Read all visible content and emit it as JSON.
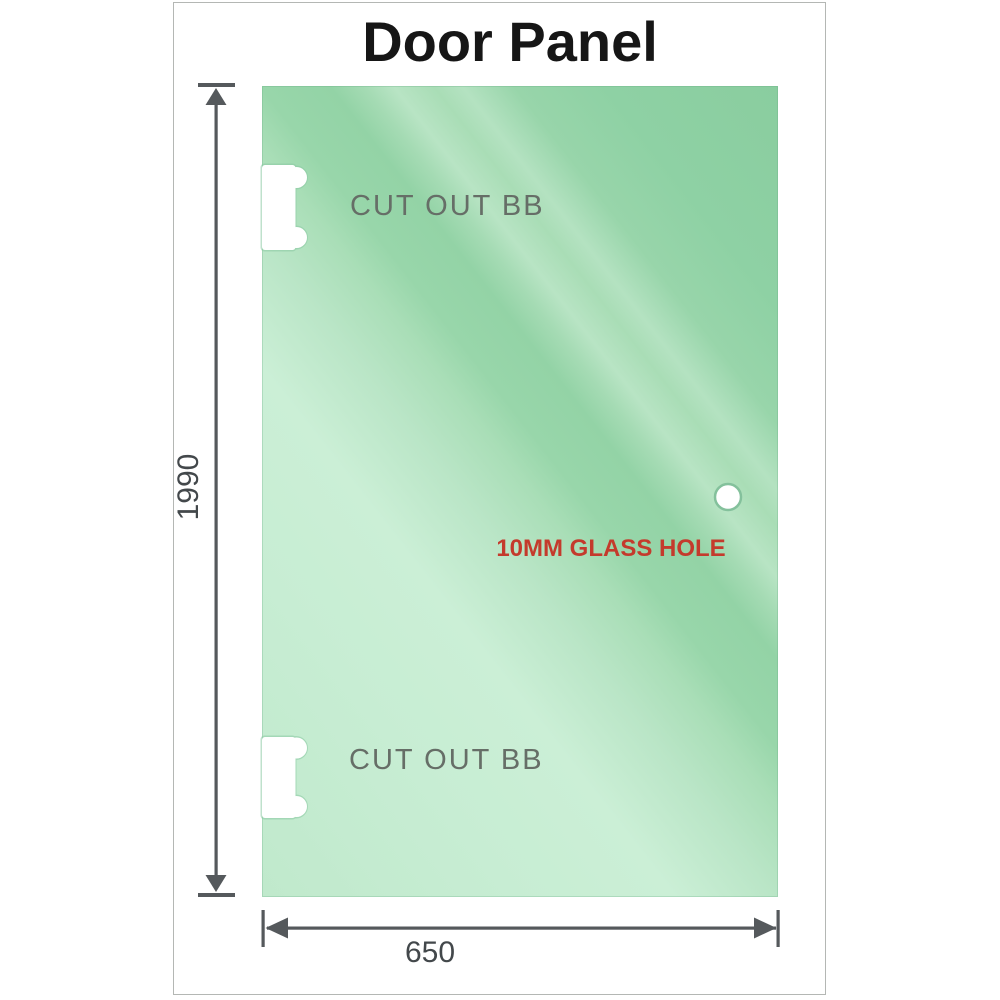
{
  "title": "Door Panel",
  "panel": {
    "cutouts": [
      {
        "label": "CUT OUT BB"
      },
      {
        "label": "CUT OUT BB"
      }
    ],
    "hole": {
      "label": "10MM GLASS HOLE"
    }
  },
  "dimensions": {
    "height": "1990",
    "width": "650"
  },
  "colors": {
    "glass_base": "#a9deb7",
    "glass_light": "#cbefd6",
    "glass_dark": "#8acd9f",
    "dimension_line": "#55595c",
    "dimension_text": "#43484b",
    "cutout_label": "#666e67",
    "cutout_halo": "#8bc9a3",
    "hole_ring": "#84c19c",
    "hole_label": "#c43a2c",
    "frame_border": "#b4b7b4",
    "title_color": "#161616"
  }
}
